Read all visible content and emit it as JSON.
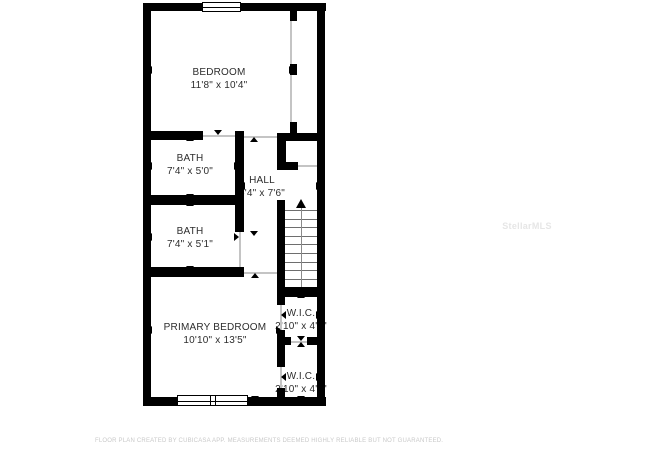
{
  "floorplan": {
    "rooms": [
      {
        "id": "bedroom",
        "name": "BEDROOM",
        "dims": "11'8\" x 10'4\"",
        "cx": 219,
        "cy": 79
      },
      {
        "id": "bath-1",
        "name": "BATH",
        "dims": "7'4\" x 5'0\"",
        "cx": 190,
        "cy": 165
      },
      {
        "id": "hall",
        "name": "HALL",
        "dims": "6'4\" x 7'6\"",
        "cx": 262,
        "cy": 187
      },
      {
        "id": "bath-2",
        "name": "BATH",
        "dims": "7'4\" x 5'1\"",
        "cx": 190,
        "cy": 238
      },
      {
        "id": "primary-bedroom",
        "name": "PRIMARY BEDROOM",
        "dims": "10'10\" x 13'5\"",
        "cx": 215,
        "cy": 334
      },
      {
        "id": "wic-1",
        "name": "W.I.C.",
        "dims": "2'10\" x 4'1\"",
        "cx": 301,
        "cy": 320
      },
      {
        "id": "wic-2",
        "name": "W.I.C.",
        "dims": "2'10\" x 4'4\"",
        "cx": 301,
        "cy": 383
      }
    ],
    "walls": [
      {
        "name": "outer-top",
        "x": 143,
        "y": 3,
        "w": 183,
        "h": 8
      },
      {
        "name": "outer-bottom",
        "x": 143,
        "y": 397,
        "w": 183,
        "h": 9
      },
      {
        "name": "outer-left",
        "x": 143,
        "y": 3,
        "w": 8,
        "h": 403
      },
      {
        "name": "outer-right",
        "x": 317,
        "y": 3,
        "w": 8,
        "h": 403
      },
      {
        "name": "bedroom-right-top",
        "x": 290,
        "y": 11,
        "w": 7,
        "h": 10
      },
      {
        "name": "bedroom-right-mid",
        "x": 290,
        "y": 64,
        "w": 7,
        "h": 11
      },
      {
        "name": "bedroom-right-bottom",
        "x": 290,
        "y": 122,
        "w": 7,
        "h": 11
      },
      {
        "name": "bedroom-bath-wall",
        "x": 151,
        "y": 131,
        "w": 52,
        "h": 9
      },
      {
        "name": "hall-left-wall",
        "x": 235,
        "y": 131,
        "w": 9,
        "h": 101
      },
      {
        "name": "bath-separator",
        "x": 151,
        "y": 195,
        "w": 85,
        "h": 10
      },
      {
        "name": "bath2-bottom-wall",
        "x": 151,
        "y": 267,
        "w": 93,
        "h": 10
      },
      {
        "name": "strip-top-wall",
        "x": 277,
        "y": 133,
        "w": 40,
        "h": 8
      },
      {
        "name": "pocket-left-bar",
        "x": 277,
        "y": 141,
        "w": 9,
        "h": 29
      },
      {
        "name": "pocket-bottom-stub",
        "x": 277,
        "y": 162,
        "w": 21,
        "h": 8
      },
      {
        "name": "stairs-left-wall",
        "x": 277,
        "y": 200,
        "w": 8,
        "h": 90
      },
      {
        "name": "stairs-bottom-wall",
        "x": 277,
        "y": 287,
        "w": 48,
        "h": 10
      },
      {
        "name": "wic-separator-left",
        "x": 277,
        "y": 337,
        "w": 14,
        "h": 8
      },
      {
        "name": "wic-separator-right",
        "x": 307,
        "y": 337,
        "w": 18,
        "h": 8
      },
      {
        "name": "wic1-left-top",
        "x": 277,
        "y": 297,
        "w": 8,
        "h": 8
      },
      {
        "name": "wic1-left-bottom",
        "x": 277,
        "y": 330,
        "w": 8,
        "h": 7
      },
      {
        "name": "wic2-left-top",
        "x": 277,
        "y": 345,
        "w": 8,
        "h": 22
      },
      {
        "name": "wic2-left-bottom",
        "x": 277,
        "y": 388,
        "w": 8,
        "h": 9
      }
    ],
    "openings": [
      {
        "name": "bedroom-right-opening-upper",
        "x": 290,
        "y": 21,
        "w": 1.5,
        "h": 43
      },
      {
        "name": "bedroom-right-opening-lower",
        "x": 290,
        "y": 75,
        "w": 1.5,
        "h": 47
      },
      {
        "name": "bath1-door-opening",
        "x": 203,
        "y": 135,
        "w": 32,
        "h": 1.5
      },
      {
        "name": "bedroom-door-opening",
        "x": 244,
        "y": 136,
        "w": 33,
        "h": 1.5
      },
      {
        "name": "pocket-opening",
        "x": 298,
        "y": 165,
        "w": 19,
        "h": 1.5
      },
      {
        "name": "bath2-door-opening",
        "x": 239,
        "y": 232,
        "w": 1.5,
        "h": 35
      },
      {
        "name": "hall-primary-passage",
        "x": 244,
        "y": 272,
        "w": 33,
        "h": 1.5
      },
      {
        "name": "wic1-door-opening",
        "x": 280,
        "y": 305,
        "w": 1.5,
        "h": 25
      },
      {
        "name": "wic-separator-gap",
        "x": 291,
        "y": 341,
        "w": 16,
        "h": 1.5
      },
      {
        "name": "wic2-door-opening",
        "x": 280,
        "y": 367,
        "w": 1.5,
        "h": 21
      }
    ],
    "windows": [
      {
        "name": "bedroom-window",
        "x": 202,
        "y": 2,
        "w": 39,
        "h": 10,
        "style": "single"
      },
      {
        "name": "primary-bedroom-window",
        "x": 177,
        "y": 395,
        "w": 71,
        "h": 11,
        "style": "double"
      }
    ],
    "stairs": {
      "name": "staircase",
      "x": 285,
      "y": 200,
      "w": 32,
      "h": 87,
      "tread_start_y": 210,
      "tread_step": 8.6,
      "tread_count": 9,
      "center_x": 301,
      "arrow_tip_y": 199,
      "direction": "up"
    },
    "arrows": [
      {
        "room": "bedroom",
        "dir": "left",
        "x": 152,
        "y": 70
      },
      {
        "room": "bedroom",
        "dir": "right",
        "x": 289,
        "y": 70
      },
      {
        "room": "bedroom",
        "dir": "up",
        "x": 218,
        "y": 12
      },
      {
        "room": "bedroom",
        "dir": "down",
        "x": 218,
        "y": 130
      },
      {
        "room": "bath-1",
        "dir": "left",
        "x": 152,
        "y": 166
      },
      {
        "room": "bath-1",
        "dir": "right",
        "x": 234,
        "y": 166
      },
      {
        "room": "bath-1",
        "dir": "up",
        "x": 190,
        "y": 141
      },
      {
        "room": "bath-1",
        "dir": "down",
        "x": 190,
        "y": 194
      },
      {
        "room": "bath-2",
        "dir": "left",
        "x": 152,
        "y": 237
      },
      {
        "room": "bath-2",
        "dir": "right",
        "x": 234,
        "y": 237
      },
      {
        "room": "bath-2",
        "dir": "up",
        "x": 190,
        "y": 206
      },
      {
        "room": "bath-2",
        "dir": "down",
        "x": 190,
        "y": 266
      },
      {
        "room": "hall",
        "dir": "left",
        "x": 245,
        "y": 186
      },
      {
        "room": "hall",
        "dir": "right",
        "x": 316,
        "y": 186
      },
      {
        "room": "hall",
        "dir": "up",
        "x": 254,
        "y": 142
      },
      {
        "room": "hall",
        "dir": "down",
        "x": 254,
        "y": 231
      },
      {
        "room": "primary-bedroom",
        "dir": "left",
        "x": 152,
        "y": 330
      },
      {
        "room": "primary-bedroom",
        "dir": "right",
        "x": 276,
        "y": 330
      },
      {
        "room": "primary-bedroom",
        "dir": "up",
        "x": 255,
        "y": 278
      },
      {
        "room": "primary-bedroom",
        "dir": "down",
        "x": 255,
        "y": 396
      },
      {
        "room": "wic-1",
        "dir": "left",
        "x": 286,
        "y": 315
      },
      {
        "room": "wic-1",
        "dir": "right",
        "x": 316,
        "y": 315
      },
      {
        "room": "wic-1",
        "dir": "up",
        "x": 301,
        "y": 298
      },
      {
        "room": "wic-1",
        "dir": "down",
        "x": 301,
        "y": 336
      },
      {
        "room": "wic-2",
        "dir": "left",
        "x": 286,
        "y": 377
      },
      {
        "room": "wic-2",
        "dir": "right",
        "x": 316,
        "y": 377
      },
      {
        "room": "wic-2",
        "dir": "up",
        "x": 301,
        "y": 347
      },
      {
        "room": "wic-2",
        "dir": "down",
        "x": 301,
        "y": 396
      }
    ]
  },
  "watermark": {
    "text": "StellarMLS",
    "cx": 527,
    "cy": 226
  },
  "footer": {
    "text": "FLOOR PLAN CREATED BY CUBICASA APP. MEASUREMENTS DEEMED HIGHLY RELIABLE BUT NOT GUARANTEED.",
    "y": 438
  },
  "colors": {
    "wall": "#000000",
    "text": "#2d2d2d",
    "opening": "#c4c4c4",
    "footer": "#c9c9c9",
    "watermark": "#e6e6e6"
  }
}
